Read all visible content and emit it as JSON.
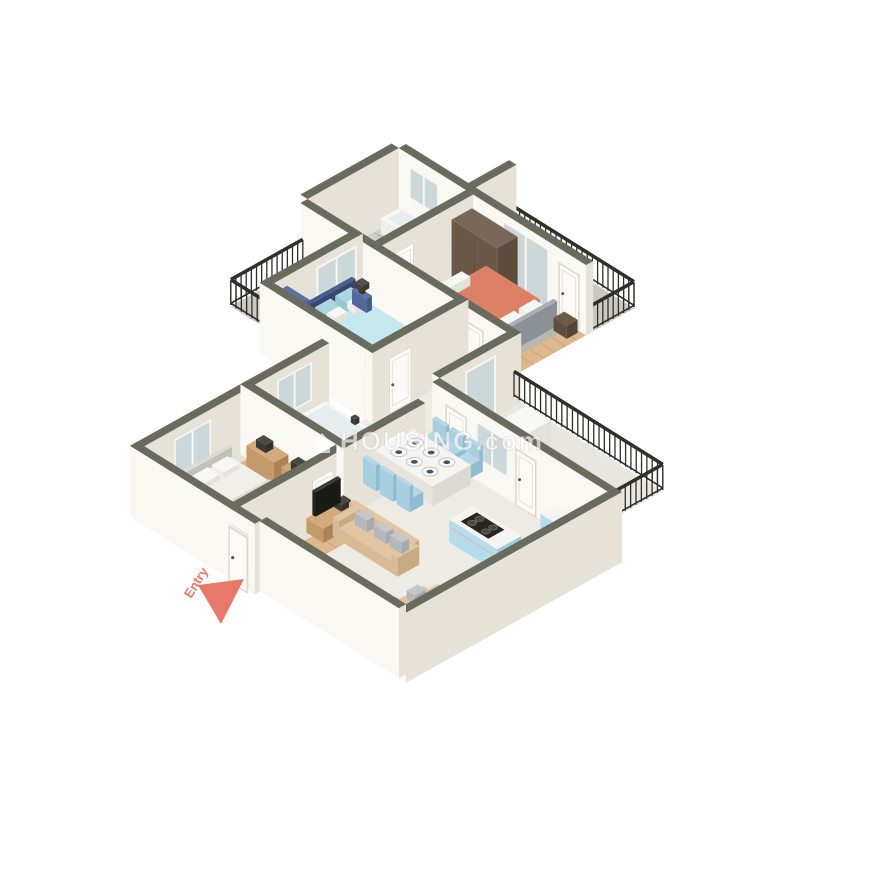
{
  "watermark": {
    "text": "HOUSING.com",
    "icon": "house-icon",
    "color": "#ffffff",
    "opacity": 0.62
  },
  "entry_marker": {
    "label": "Entry",
    "color": "#e8796a"
  },
  "palette": {
    "background": "#ffffff",
    "wall_top": "#696b5e",
    "wall_face": "#faf8f3",
    "wall_side": "#e6e2d8",
    "wood_floor": "#ddb88f",
    "marble_floor": "#edebe4",
    "tile_floor": "#cfcfca",
    "balcony_floor": "#c9c9c0",
    "terrace_floor": "#e8e6df",
    "railing_iron": "#30302a",
    "glass": "#ccd7da",
    "door_white": "#fbfaf7",
    "mattress_white": "#f0efe9",
    "bed_master_frame": "#46598a",
    "duvet_cyan": "#c6e7ed",
    "pillow_cyan": "#a9d8e2",
    "duvet_coral": "#dd8166",
    "rug_gray": "#b8b8b0",
    "rug_light": "#ece6da",
    "wardrobe_navy": "#52679b",
    "wardrobe_brown": "#6b5846",
    "wood_furniture": "#c49a6c",
    "sofa_beige": "#e2c6a2",
    "sofa_pillow_gray": "#c3c7ca",
    "dining_chair_cyan": "#a8cfdf",
    "kitchen_counter_blue": "#b5dcec",
    "counter_top_white": "#f4f4f0",
    "stove_black": "#26261f",
    "sink_wood": "#8a6b4e",
    "dark_item": "#3a3a35"
  },
  "rooms": [
    {
      "name": "top-bathroom",
      "furniture": [
        "bathtub",
        "toilet",
        "sink-vanity",
        "window"
      ]
    },
    {
      "name": "dressing-area",
      "furniture": [
        "wardrobe-brown"
      ]
    },
    {
      "name": "top-bedroom",
      "furniture": [
        "double-bed-coral",
        "gray-rug",
        "bench",
        "side-table",
        "balcony-glass-door"
      ]
    },
    {
      "name": "top-balcony",
      "furniture": [
        "iron-railing"
      ]
    },
    {
      "name": "master-bedroom",
      "furniture": [
        "double-bed-navy-cyan",
        "nightstand-left",
        "nightstand-right",
        "lamps",
        "wardrobe-navy",
        "light-rug",
        "sliding-glass-door"
      ]
    },
    {
      "name": "small-balcony",
      "furniture": [
        "iron-railing"
      ]
    },
    {
      "name": "hallway",
      "furniture": [
        "white-doors"
      ]
    },
    {
      "name": "dining-area",
      "furniture": [
        "dining-table",
        "six-cyan-chairs",
        "six-plates"
      ]
    },
    {
      "name": "utility-terrace",
      "furniture": [
        "white-cabinet",
        "iron-railing"
      ]
    },
    {
      "name": "kitchen",
      "furniture": [
        "stove-island",
        "l-shaped-counter",
        "wooden-sink-basin"
      ]
    },
    {
      "name": "living-room",
      "furniture": [
        "long-sofa",
        "bench-sofas",
        "gray-cushions",
        "tv-console"
      ]
    },
    {
      "name": "west-bedroom",
      "furniture": [
        "single-bed-white",
        "desk",
        "desk-lamp",
        "desk-chair",
        "wooden-shelves",
        "armchair",
        "window"
      ]
    },
    {
      "name": "west-bathroom",
      "furniture": [
        "bathtub",
        "toilet",
        "sink",
        "window"
      ]
    },
    {
      "name": "foyer",
      "furniture": [
        "entry-door-open",
        "entry-arrow"
      ]
    }
  ]
}
